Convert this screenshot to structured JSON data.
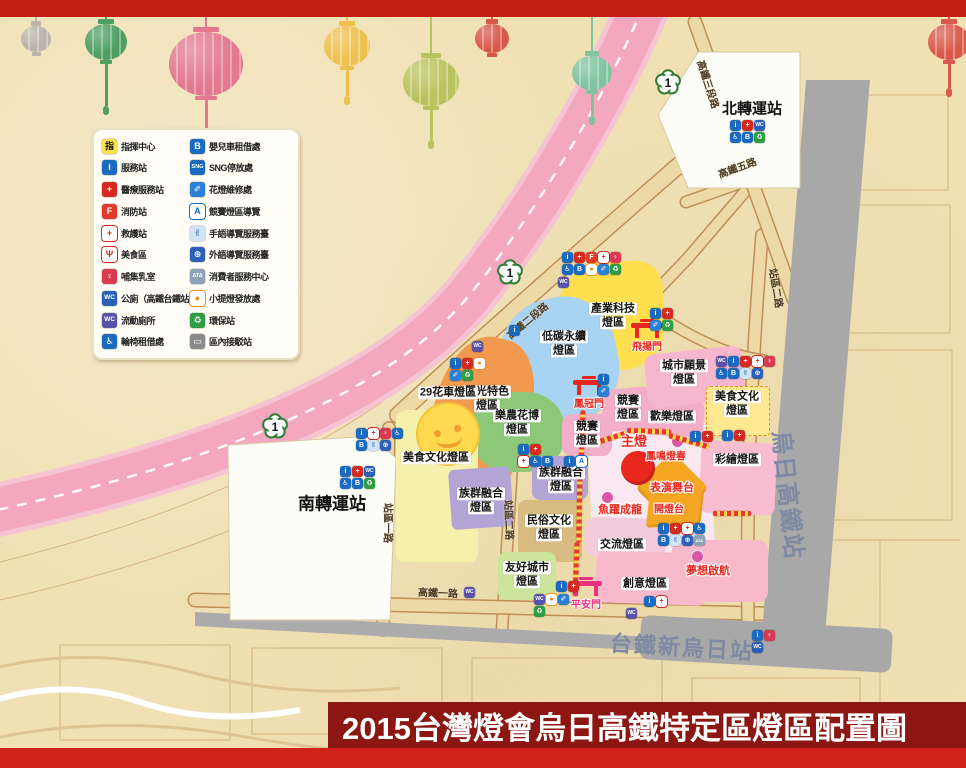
{
  "title_banner": {
    "title": "2015台灣燈會烏日高鐵特定區燈區配置圖"
  },
  "decor": {
    "lanterns": [
      {
        "x": 36,
        "y": 26,
        "s": 30,
        "color": "#b9b3a8",
        "tassel": 0
      },
      {
        "x": 106,
        "y": 22,
        "s": 42,
        "color": "#4f9e62",
        "tassel": 42
      },
      {
        "x": 206,
        "y": 32,
        "s": 74,
        "color": "#e2798f",
        "tassel": 46
      },
      {
        "x": 347,
        "y": 26,
        "s": 46,
        "color": "#eec04f",
        "tassel": 26
      },
      {
        "x": 431,
        "y": 58,
        "s": 56,
        "color": "#b9c35c",
        "tassel": 30
      },
      {
        "x": 492,
        "y": 22,
        "s": 34,
        "color": "#d8584a",
        "tassel": 0
      },
      {
        "x": 592,
        "y": 56,
        "s": 40,
        "color": "#7fc49e",
        "tassel": 22
      },
      {
        "x": 949,
        "y": 20,
        "s": 42,
        "color": "#d8584a",
        "tassel": 24
      }
    ]
  },
  "icon_defs": {
    "command": {
      "name": "command-center-icon",
      "glyph": "指",
      "bg": "#fce34b",
      "fg": "#111111"
    },
    "info": {
      "name": "service-station-icon",
      "glyph": "i",
      "bg": "#1a6bbf",
      "fg": "#ffffff"
    },
    "medical": {
      "name": "medical-service-icon",
      "glyph": "+",
      "bg": "#d42a20",
      "fg": "#ffffff"
    },
    "fire": {
      "name": "fire-station-icon",
      "glyph": "F",
      "bg": "#e03a28",
      "fg": "#ffffff"
    },
    "aid": {
      "name": "first-aid-icon",
      "glyph": "+",
      "bg": "#ffffff",
      "fg": "#d42a20"
    },
    "food": {
      "name": "food-area-icon",
      "glyph": "Ψ",
      "bg": "#ffffff",
      "fg": "#d42a20"
    },
    "nursing": {
      "name": "nursing-room-icon",
      "glyph": "♀",
      "bg": "#d93a52",
      "fg": "#ffffff"
    },
    "toilet": {
      "name": "public-toilet-icon",
      "glyph": "WC",
      "bg": "#2b5fb8",
      "fg": "#ffffff"
    },
    "ptoilet": {
      "name": "portable-toilet-icon",
      "glyph": "WC",
      "bg": "#5a52a8",
      "fg": "#ffffff"
    },
    "wheelchair": {
      "name": "wheelchair-rental-icon",
      "glyph": "♿",
      "bg": "#1a6bbf",
      "fg": "#ffffff"
    },
    "stroller": {
      "name": "stroller-rental-icon",
      "glyph": "B",
      "bg": "#1a6bbf",
      "fg": "#ffffff"
    },
    "sng": {
      "name": "sng-parking-icon",
      "glyph": "SNG",
      "bg": "#1a6bbf",
      "fg": "#ffffff"
    },
    "repair": {
      "name": "lantern-repair-icon",
      "glyph": "✐",
      "bg": "#2b7fd4",
      "fg": "#ffffff"
    },
    "guide": {
      "name": "contest-zone-guide-icon",
      "glyph": "A",
      "bg": "#ffffff",
      "fg": "#1a6bbf"
    },
    "sign": {
      "name": "sign-language-guide-icon",
      "glyph": "✌",
      "bg": "#cfe4f7",
      "fg": "#1a4f9c"
    },
    "globe": {
      "name": "foreign-language-guide-icon",
      "glyph": "⊕",
      "bg": "#2b5fb8",
      "fg": "#ffffff"
    },
    "consumer": {
      "name": "consumer-service-icon",
      "glyph": "ΔΤΔ",
      "bg": "#8fa3b8",
      "fg": "#ffffff"
    },
    "lantern": {
      "name": "small-lantern-distribution-icon",
      "glyph": "●",
      "bg": "#ffffff",
      "fg": "#f08c1e"
    },
    "recycle": {
      "name": "recycling-station-icon",
      "glyph": "♻",
      "bg": "#2e9e44",
      "fg": "#ffffff"
    },
    "shuttle": {
      "name": "shuttle-station-icon",
      "glyph": "▭",
      "bg": "#8a8a8a",
      "fg": "#ffffff"
    }
  },
  "legend": {
    "left": [
      {
        "icon": "command",
        "label": "指揮中心"
      },
      {
        "icon": "info",
        "label": "服務站"
      },
      {
        "icon": "medical",
        "label": "醫療服務站"
      },
      {
        "icon": "fire",
        "label": "消防站"
      },
      {
        "icon": "aid",
        "label": "救護站"
      },
      {
        "icon": "food",
        "label": "美食區"
      },
      {
        "icon": "nursing",
        "label": "哺集乳室"
      },
      {
        "icon": "toilet",
        "label": "公廁（高鐵台鐵站內）"
      },
      {
        "icon": "ptoilet",
        "label": "流動廁所"
      },
      {
        "icon": "wheelchair",
        "label": "輪椅租借處"
      }
    ],
    "right": [
      {
        "icon": "stroller",
        "label": "嬰兒車租借處"
      },
      {
        "icon": "sng",
        "label": "SNG停放處"
      },
      {
        "icon": "repair",
        "label": "花燈維修處"
      },
      {
        "icon": "guide",
        "label": "競賽燈區導覽"
      },
      {
        "icon": "sign",
        "label": "手語導覽服務臺"
      },
      {
        "icon": "globe",
        "label": "外語導覽服務臺"
      },
      {
        "icon": "consumer",
        "label": "消費者服務中心"
      },
      {
        "icon": "lantern",
        "label": "小提燈發放處"
      },
      {
        "icon": "recycle",
        "label": "環保站"
      },
      {
        "icon": "shuttle",
        "label": "區內接駁站"
      }
    ]
  },
  "highway": {
    "shield_label": "1",
    "shields": [
      {
        "x": 668,
        "y": 85
      },
      {
        "x": 510,
        "y": 275
      },
      {
        "x": 275,
        "y": 429
      }
    ]
  },
  "stations": {
    "north": {
      "name": "北轉運站"
    },
    "south": {
      "name": "南轉運站"
    },
    "hsr": {
      "name": "烏日高鐵站"
    },
    "tra": {
      "name": "台鐵新烏日站"
    }
  },
  "zones": [
    {
      "id": "central-plaza",
      "x": 590,
      "y": 420,
      "w": 122,
      "h": 138,
      "bg": "#fae8f0",
      "rad": "16px",
      "rot": -3,
      "lines": []
    },
    {
      "id": "industry-tech",
      "x": 558,
      "y": 262,
      "w": 106,
      "h": 108,
      "bg": "#ffdf4e",
      "rad": "45% 25% 40% 50%",
      "rot": -3,
      "lcx": 613,
      "lcy": 316,
      "lines": [
        "產業科技",
        "燈區"
      ]
    },
    {
      "id": "low-carbon",
      "x": 500,
      "y": 298,
      "w": 118,
      "h": 126,
      "bg": "#a9d3f2",
      "rad": "48% 42% 45% 50%",
      "rot": -12,
      "lcx": 564,
      "lcy": 344,
      "lines": [
        "低碳永續",
        "燈區"
      ]
    },
    {
      "id": "tourism",
      "x": 432,
      "y": 336,
      "w": 96,
      "h": 168,
      "bg": "#f0994f",
      "rad": "45% 40% 42% 48%",
      "rot": 14,
      "lcx": 487,
      "lcy": 399,
      "lines": [
        "觀光特色",
        "燈區"
      ]
    },
    {
      "id": "flora",
      "x": 472,
      "y": 392,
      "w": 92,
      "h": 80,
      "bg": "#8cc878",
      "rad": "42%",
      "rot": 0,
      "lcx": 517,
      "lcy": 423,
      "lines": [
        "樂農花博",
        "燈區"
      ]
    },
    {
      "id": "food-culture-west",
      "x": 396,
      "y": 410,
      "w": 82,
      "h": 152,
      "bg": "#f6f0ad",
      "rad": "10px 26px 8px 8px",
      "rot": 0,
      "lcx": 436,
      "lcy": 458,
      "lines": [
        "美食文化燈區"
      ]
    },
    {
      "id": "dream-area",
      "x": 672,
      "y": 540,
      "w": 96,
      "h": 62,
      "bg": "#f8b9cc",
      "rad": "10px",
      "rot": 0,
      "lines": []
    },
    {
      "id": "ethnic-fusion-west",
      "x": 450,
      "y": 468,
      "w": 62,
      "h": 60,
      "bg": "#b2a4d4",
      "rad": "6px",
      "rot": -4,
      "lcx": 481,
      "lcy": 501,
      "lines": [
        "族群融合",
        "燈區"
      ]
    },
    {
      "id": "ethnic-fusion-east",
      "x": 532,
      "y": 456,
      "w": 56,
      "h": 44,
      "bg": "#b2a4d4",
      "rad": "8px",
      "rot": 0,
      "lcx": 561,
      "lcy": 480,
      "lines": [
        "族群融合",
        "燈區"
      ]
    },
    {
      "id": "folk-culture",
      "x": 518,
      "y": 500,
      "w": 64,
      "h": 62,
      "bg": "#d8bb80",
      "rad": "8px",
      "rot": 0,
      "lcx": 549,
      "lcy": 528,
      "lines": [
        "民俗文化",
        "燈區"
      ]
    },
    {
      "id": "exchange",
      "x": 586,
      "y": 518,
      "w": 80,
      "h": 40,
      "bg": "#f5cadd",
      "rad": "10px",
      "rot": 2,
      "lcx": 622,
      "lcy": 545,
      "lines": [
        "交流燈區"
      ]
    },
    {
      "id": "friendly-cities",
      "x": 498,
      "y": 552,
      "w": 58,
      "h": 48,
      "bg": "#cde49c",
      "rad": "8px",
      "rot": 0,
      "lcx": 527,
      "lcy": 575,
      "lines": [
        "友好城市",
        "燈區"
      ]
    },
    {
      "id": "creative",
      "x": 596,
      "y": 552,
      "w": 112,
      "h": 52,
      "bg": "#f8b9cc",
      "rad": "10px",
      "rot": 2,
      "lcx": 645,
      "lcy": 584,
      "lines": [
        "創意燈區"
      ]
    },
    {
      "id": "contest-north",
      "x": 602,
      "y": 388,
      "w": 52,
      "h": 42,
      "bg": "#f3aec9",
      "rad": "10px",
      "rot": -6,
      "lcx": 628,
      "lcy": 408,
      "lines": [
        "競賽",
        "燈區"
      ]
    },
    {
      "id": "contest-south",
      "x": 562,
      "y": 414,
      "w": 50,
      "h": 42,
      "bg": "#f3aec9",
      "rad": "10px",
      "rot": 0,
      "lcx": 587,
      "lcy": 434,
      "lines": [
        "競賽",
        "燈區"
      ]
    },
    {
      "id": "joy",
      "x": 640,
      "y": 398,
      "w": 64,
      "h": 38,
      "bg": "#f3aec9",
      "rad": "10px",
      "rot": 4,
      "lcx": 672,
      "lcy": 417,
      "lines": [
        "歡樂燈區"
      ]
    },
    {
      "id": "city-vision",
      "x": 646,
      "y": 350,
      "w": 98,
      "h": 54,
      "bg": "#f5b6ce",
      "rad": "10px",
      "rot": -6,
      "lcx": 684,
      "lcy": 373,
      "lines": [
        "城市願景",
        "燈區"
      ]
    },
    {
      "id": "painted",
      "x": 700,
      "y": 442,
      "w": 76,
      "h": 72,
      "bg": "#f8bdd1",
      "rad": "8px",
      "rot": 3,
      "lcx": 737,
      "lcy": 460,
      "lines": [
        "彩繪燈區"
      ]
    },
    {
      "id": "food-culture-east",
      "x": 706,
      "y": 386,
      "w": 62,
      "h": 48,
      "bg": "#ffe892",
      "rad": "4px",
      "rot": 0,
      "dashed": true,
      "lcx": 737,
      "lcy": 404,
      "lines": [
        "美食文化",
        "燈區"
      ]
    }
  ],
  "plain_labels": [
    {
      "text": "29花車燈區",
      "x": 448,
      "y": 393
    }
  ],
  "red_labels": [
    {
      "id": "main-lantern-label",
      "text": "主燈",
      "x": 634,
      "y": 440,
      "fs": 13
    },
    {
      "id": "performance-stage-label",
      "text": "表演舞台",
      "x": 672,
      "y": 487,
      "fs": 11
    },
    {
      "id": "lighting-platform-label",
      "text": "開燈台",
      "x": 669,
      "y": 508,
      "fs": 10
    },
    {
      "id": "fish-dragon-sublantern-label",
      "text": "魚躍成龍",
      "x": 620,
      "y": 509,
      "fs": 11
    },
    {
      "id": "phoenix-sublantern-label",
      "text": "鳳鳴燈春",
      "x": 666,
      "y": 455,
      "fs": 10
    },
    {
      "id": "dream-sailing-sublantern-label",
      "text": "夢想啟航",
      "x": 708,
      "y": 570,
      "fs": 11
    }
  ],
  "sub_lantern_dots": [
    {
      "x": 677,
      "y": 441
    },
    {
      "x": 607,
      "y": 497
    },
    {
      "x": 697,
      "y": 556
    }
  ],
  "gates": [
    {
      "id": "flying-gate",
      "label": "飛揚門",
      "x": 647,
      "y": 336,
      "color": "#e8281e"
    },
    {
      "id": "phoenix-crown-gate",
      "label": "鳳冠門",
      "x": 589,
      "y": 393,
      "color": "#e8281e"
    },
    {
      "id": "peace-gate",
      "label": "平安門",
      "x": 586,
      "y": 594,
      "color": "#e8327e"
    }
  ],
  "road_labels": [
    {
      "text": "高鐵三段路",
      "x": 709,
      "y": 84,
      "rot": 72
    },
    {
      "text": "高鐵五路",
      "x": 737,
      "y": 167,
      "rot": -20
    },
    {
      "text": "高鐵二段路",
      "x": 527,
      "y": 320,
      "rot": -40
    },
    {
      "text": "站區二路",
      "x": 777,
      "y": 288,
      "rot": 80
    },
    {
      "text": "站區一路",
      "x": 389,
      "y": 523,
      "rot": 90
    },
    {
      "text": "站區二路",
      "x": 510,
      "y": 520,
      "rot": 88
    },
    {
      "text": "高鐵一路",
      "x": 438,
      "y": 592,
      "rot": 2
    }
  ],
  "icon_clusters": [
    {
      "x": 562,
      "y": 252,
      "rows": [
        [
          "info",
          "medical",
          "fire",
          "aid",
          "nursing"
        ],
        [
          "wheelchair",
          "stroller",
          "lantern",
          "repair",
          "recycle"
        ]
      ]
    },
    {
      "x": 558,
      "y": 277,
      "rows": [
        [
          "ptoilet"
        ]
      ]
    },
    {
      "x": 450,
      "y": 358,
      "rows": [
        [
          "info",
          "medical",
          "lantern"
        ],
        [
          "repair",
          "recycle"
        ]
      ]
    },
    {
      "x": 472,
      "y": 341,
      "rows": [
        [
          "ptoilet"
        ]
      ]
    },
    {
      "x": 509,
      "y": 325,
      "rows": [
        [
          "info"
        ]
      ]
    },
    {
      "x": 356,
      "y": 428,
      "rows": [
        [
          "info",
          "aid",
          "nursing",
          "wheelchair"
        ],
        [
          "stroller",
          "sign",
          "globe"
        ]
      ]
    },
    {
      "x": 340,
      "y": 466,
      "rows": [
        [
          "info",
          "medical",
          "toilet"
        ],
        [
          "wheelchair",
          "stroller",
          "recycle"
        ]
      ]
    },
    {
      "x": 730,
      "y": 120,
      "rows": [
        [
          "info",
          "medical",
          "toilet"
        ],
        [
          "wheelchair",
          "stroller",
          "recycle"
        ]
      ]
    },
    {
      "x": 650,
      "y": 308,
      "rows": [
        [
          "info",
          "medical"
        ],
        [
          "repair",
          "recycle"
        ]
      ]
    },
    {
      "x": 598,
      "y": 374,
      "rows": [
        [
          "info"
        ],
        [
          "repair"
        ]
      ]
    },
    {
      "x": 564,
      "y": 456,
      "rows": [
        [
          "info",
          "guide"
        ]
      ]
    },
    {
      "x": 518,
      "y": 444,
      "rows": [
        [
          "info",
          "medical"
        ],
        [
          "aid",
          "wheelchair",
          "stroller"
        ]
      ]
    },
    {
      "x": 716,
      "y": 356,
      "rows": [
        [
          "ptoilet",
          "info",
          "medical",
          "aid",
          "nursing"
        ],
        [
          "wheelchair",
          "stroller",
          "sign",
          "globe"
        ]
      ]
    },
    {
      "x": 722,
      "y": 430,
      "rows": [
        [
          "info",
          "medical"
        ]
      ]
    },
    {
      "x": 690,
      "y": 431,
      "rows": [
        [
          "info",
          "medical"
        ]
      ]
    },
    {
      "x": 658,
      "y": 523,
      "rows": [
        [
          "info",
          "medical",
          "aid",
          "wheelchair"
        ],
        [
          "stroller",
          "sign",
          "globe",
          "consumer"
        ]
      ]
    },
    {
      "x": 752,
      "y": 630,
      "rows": [
        [
          "info",
          "nursing"
        ],
        [
          "toilet"
        ]
      ]
    },
    {
      "x": 534,
      "y": 594,
      "rows": [
        [
          "ptoilet",
          "lantern",
          "repair"
        ],
        [
          "recycle"
        ]
      ]
    },
    {
      "x": 556,
      "y": 581,
      "rows": [
        [
          "info",
          "medical"
        ]
      ]
    },
    {
      "x": 644,
      "y": 596,
      "rows": [
        [
          "info",
          "aid"
        ]
      ]
    },
    {
      "x": 626,
      "y": 608,
      "rows": [
        [
          "ptoilet"
        ]
      ]
    },
    {
      "x": 464,
      "y": 587,
      "rows": [
        [
          "ptoilet"
        ]
      ]
    }
  ]
}
